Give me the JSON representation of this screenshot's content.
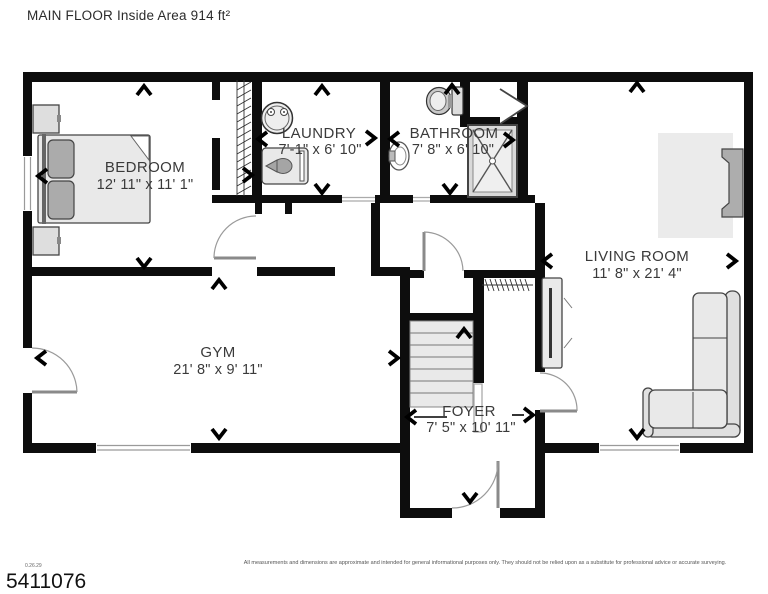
{
  "title": "MAIN FLOOR Inside Area 914 ft²",
  "rooms": {
    "bedroom": {
      "name": "BEDROOM",
      "dims": "12' 11\" x 11' 1\""
    },
    "laundry": {
      "name": "LAUNDRY",
      "dims": "7'-1\" x 6' 10\""
    },
    "bathroom": {
      "name": "BATHROOM",
      "dims": "7' 8\" x 6' 10\""
    },
    "living_room": {
      "name": "LIVING ROOM",
      "dims": "11' 8\" x 21' 4\""
    },
    "gym": {
      "name": "GYM",
      "dims": "21' 8\" x 9' 11\""
    },
    "foyer": {
      "name": "FOYER",
      "dims": "7' 5\" x 10' 11\""
    }
  },
  "footer": {
    "version": "0.26.29",
    "listing_number": "5411076",
    "disclaimer": "All measurements and dimensions are approximate and intended for general informational purposes only. They should not be relied upon as a substitute for professional advice or accurate surveying."
  },
  "colors": {
    "wall": "#0d0d0d",
    "furniture_fill": "#e9e9e9",
    "accent_gray": "#adadad"
  }
}
